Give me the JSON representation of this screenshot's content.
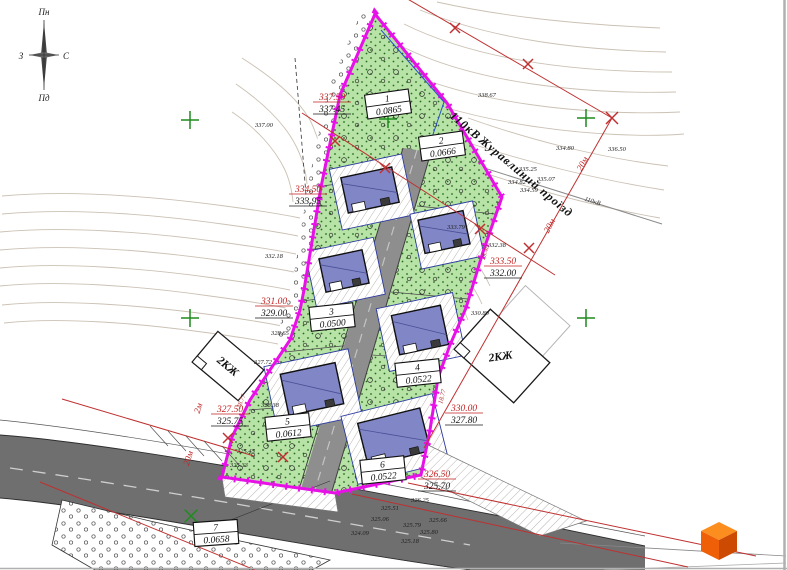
{
  "compass": {
    "north": "Пн",
    "south": "Пд",
    "west": "З",
    "east": "С"
  },
  "street": {
    "powerline": "110кВ",
    "name": "Журавлиний проїзд",
    "powerline_small": "110кВ"
  },
  "plots": [
    {
      "number": "1",
      "area": "0.0865"
    },
    {
      "number": "2",
      "area": "0.0666"
    },
    {
      "number": "3",
      "area": "0.0500"
    },
    {
      "number": "4",
      "area": "0.0522"
    },
    {
      "number": "5",
      "area": "0.0612"
    },
    {
      "number": "6",
      "area": "0.0522"
    },
    {
      "number": "7",
      "area": "0.0658"
    }
  ],
  "levels": [
    {
      "design": "337.50",
      "existing": "337.45"
    },
    {
      "design": "334.50",
      "existing": "333.95"
    },
    {
      "design": "331.00",
      "existing": "329.00"
    },
    {
      "design": "327.50",
      "existing": "325.75"
    },
    {
      "design": "333.50",
      "existing": "332.00"
    },
    {
      "design": "330.00",
      "existing": "327.80"
    },
    {
      "design": "326.50",
      "existing": "325.70"
    }
  ],
  "neighbors": {
    "left": "2КЖ",
    "right": "2КЖ"
  },
  "zone": {
    "w1": "20м",
    "w2": "20м",
    "w3": "20м",
    "w4": "2м"
  },
  "segments": [
    "38.77",
    "18.77",
    "23.40"
  ],
  "spots": [
    "337.00",
    "338.67",
    "336.50",
    "334.80",
    "335.25",
    "335.07",
    "334.82",
    "334.59",
    "333.79",
    "332.38",
    "332.18",
    "330.80",
    "328.65",
    "327.72",
    "328.38",
    "326.25",
    "325.51",
    "325.06",
    "325.79",
    "325.66",
    "325.80",
    "324.09",
    "325.18",
    "325.45",
    "325.33"
  ],
  "colors": {
    "boundary": "#e711e7",
    "zone_line": "#bf3030",
    "plot_fill": "#b7e3a6",
    "house_fill": "#8186c6"
  }
}
